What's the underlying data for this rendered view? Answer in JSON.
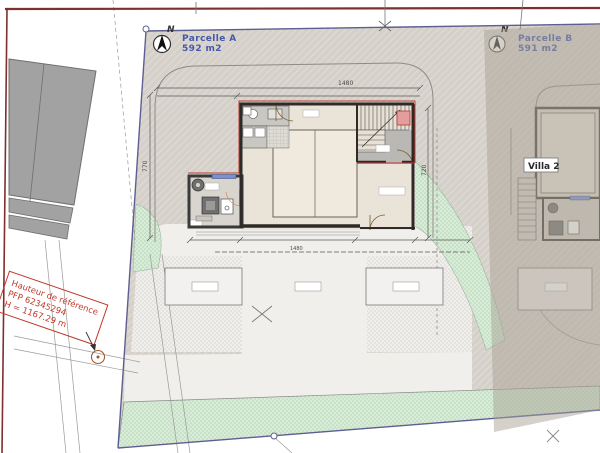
{
  "site_plan": {
    "north_label": "N",
    "parcels": {
      "a": {
        "name": "Parcelle A",
        "area": "592 m2"
      },
      "b": {
        "name": "Parcelle B",
        "area": "591 m2"
      }
    },
    "villa2_label": "Villa 2",
    "reference_note": {
      "line1": "Hauteur de référence",
      "line2": "PFP 62345294",
      "line3": "H = 1167.29 m"
    },
    "dimensions": {
      "top_width": "1480",
      "left_height": "770",
      "right_height": "720",
      "bottom_width": "1480"
    },
    "colors": {
      "parcel_boundary": "#5e5e93",
      "road_line": "#7e2f2f",
      "annotation_red": "#c0392b",
      "parcel_label_blue": "#4558aa",
      "wall_dark": "#2d2a27",
      "roof_outline_red": "#c03a2e",
      "green_area": "#d9ecd9",
      "ground_hatch": "#d5d1ca"
    }
  }
}
